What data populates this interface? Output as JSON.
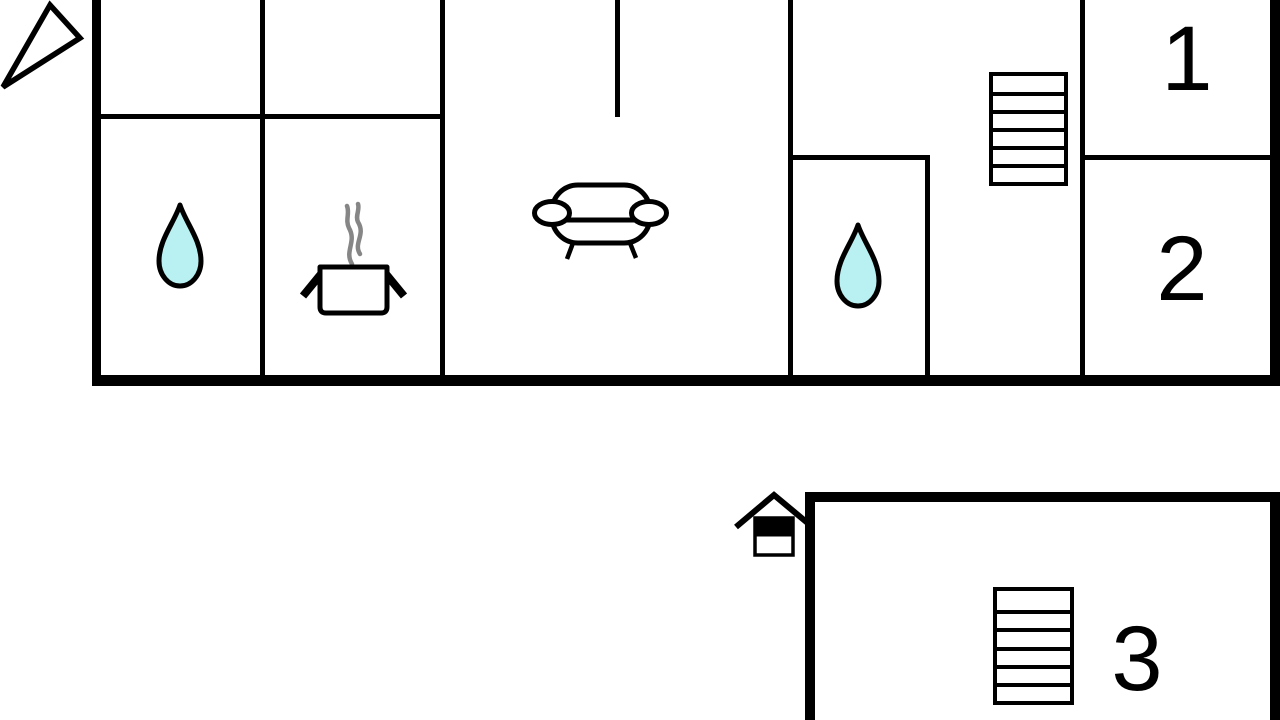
{
  "document": {
    "type": "floor-plan",
    "background": "#ffffff"
  },
  "colors": {
    "wall": "#000000",
    "water": "#b9f1f2",
    "steam": "#868686",
    "text": "#000000",
    "white": "#ffffff"
  },
  "main_floor": {
    "room_labels": {
      "bedroom_1": "1",
      "bedroom_2": "2"
    },
    "icons": [
      "north-arrow-icon",
      "water-drop-icon",
      "cooking-pot-icon",
      "steam-icon",
      "sofa-icon",
      "water-drop-icon",
      "stairs-icon"
    ]
  },
  "annex": {
    "room_labels": {
      "bedroom_3": "3"
    },
    "icons": [
      "house-marker-icon",
      "stairs-icon"
    ]
  }
}
